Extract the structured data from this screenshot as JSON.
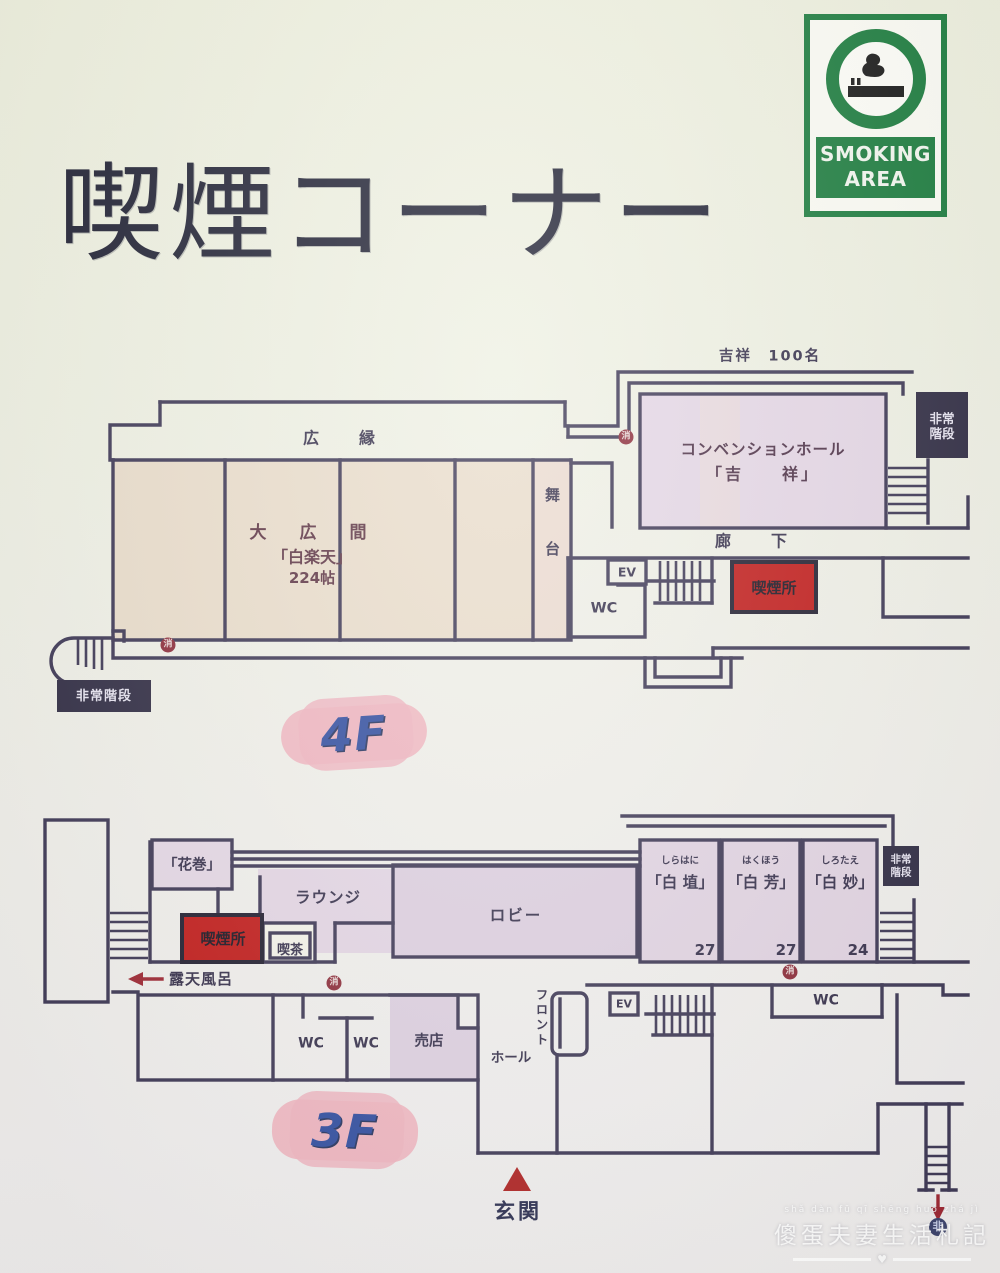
{
  "title": "喫煙コーナー",
  "sign": {
    "line1": "SMOKING",
    "line2": "AREA",
    "green": "#17793a"
  },
  "floor4": {
    "badge": "4F",
    "kisshou_cap": "吉祥　100名",
    "hiroen": "広　縁",
    "ohiroma1": "大　広　間",
    "ohiroma2": "「白楽天」",
    "ohiroma3": "224帖",
    "butai": "舞台",
    "conv1": "コンベンションホール",
    "conv2": "「吉　　祥」",
    "rouka": "廊　下",
    "ev": "EV",
    "wc": "WC",
    "kitsuen": "喫煙所",
    "hijou_tr": "非常階段",
    "hijou_bl": "非常階段"
  },
  "floor3": {
    "badge": "3F",
    "hanamaki": "「花巻」",
    "lounge": "ラウンジ",
    "lobby": "ロビー",
    "rooms": [
      {
        "kana": "しらはに",
        "name": "「白 埴」",
        "num": "27"
      },
      {
        "kana": "はくほう",
        "name": "「白 芳」",
        "num": "27"
      },
      {
        "kana": "しろたえ",
        "name": "「白 妙」",
        "num": "24"
      }
    ],
    "hijou": "非常階段",
    "kitsuen": "喫煙所",
    "kissa": "喫茶",
    "roten": "露天風呂",
    "wc_a": "WC",
    "wc_b": "WC",
    "wc_c": "WC",
    "baiten": "売店",
    "hall": "ホール",
    "front": "フロント",
    "ev": "EV",
    "genkan": "玄関"
  },
  "markers": {
    "fire": "消",
    "exit": "非"
  },
  "watermark": {
    "pinyin": "shǎ dàn fū qī shēng huó zhá jì",
    "text": "傻蛋夫妻生活札記",
    "heart": "♥"
  }
}
